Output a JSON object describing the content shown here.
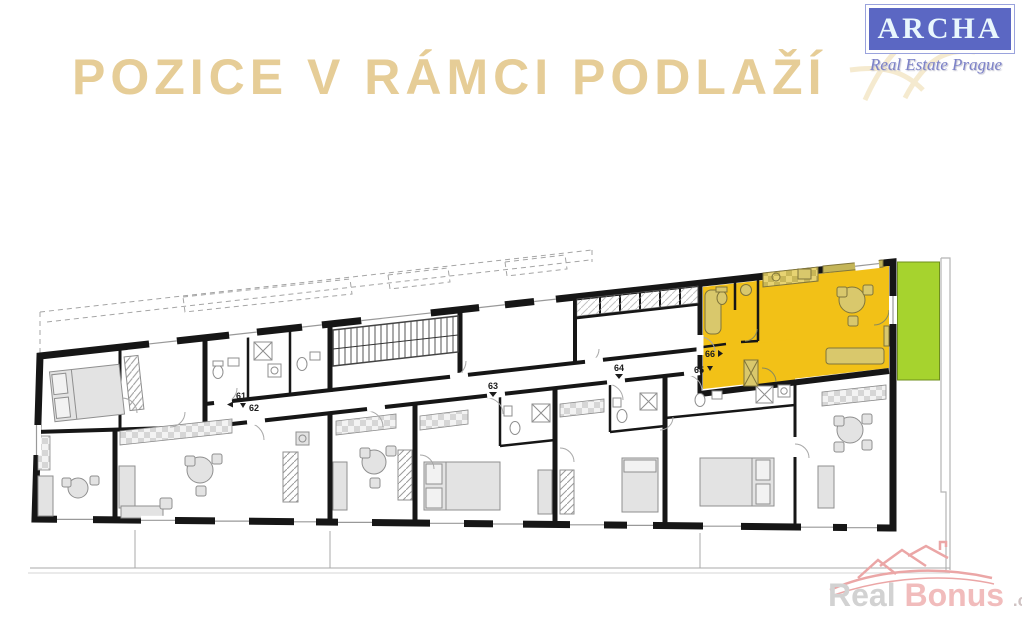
{
  "header": {
    "title": "POZICE V RÁMCI PODLAŽÍ",
    "title_color": "#E6CD97"
  },
  "logo": {
    "name": "ARCHA",
    "subtitle": "Real Estate Prague",
    "box_color": "#5B67C3",
    "text_color": "#E9F7FD"
  },
  "floorplan": {
    "highlight_color": "#F2C117",
    "balcony_color": "#A6D32E",
    "wall_color": "#161616",
    "units": [
      {
        "id": "61",
        "arrow": "left"
      },
      {
        "id": "62",
        "arrow": "down"
      },
      {
        "id": "63",
        "arrow": "down"
      },
      {
        "id": "64",
        "arrow": "down"
      },
      {
        "id": "65",
        "arrow": "down"
      },
      {
        "id": "66",
        "arrow": "right"
      }
    ]
  },
  "watermark": {
    "real": "Real",
    "bonus": "Bonus",
    "cz": ".cz"
  }
}
